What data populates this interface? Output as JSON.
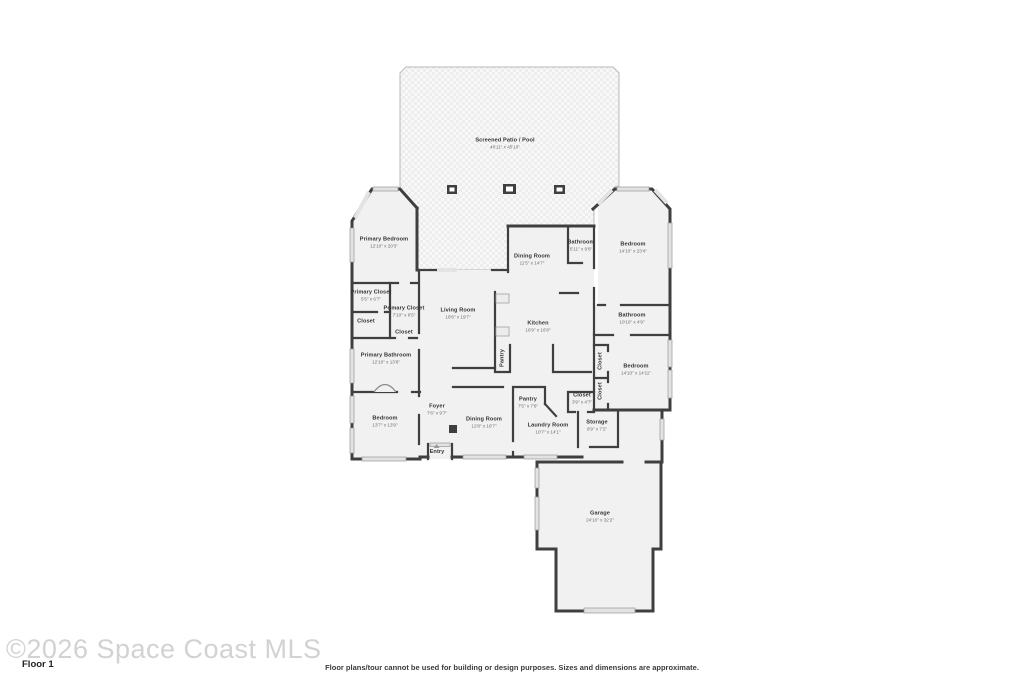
{
  "meta": {
    "floor_label": "Floor 1",
    "watermark": "©2026 Space Coast MLS",
    "disclaimer": "Floor plans/tour cannot be used for building or design purposes. Sizes and dimensions are approximate."
  },
  "colors": {
    "wall": "#3f3f3f",
    "room_fill": "#f1f1f2",
    "window": "#e3e3e3",
    "label": "#333333",
    "dimension_text": "#6e6e6e",
    "watermark": "#d2d2d2"
  },
  "rooms": [
    {
      "id": "screened-patio-pool",
      "name": "Screened Patio / Pool",
      "dims": "46'11\" x 45'10\"",
      "x": 505,
      "y": 144
    },
    {
      "id": "primary-bedroom",
      "name": "Primary Bedroom",
      "dims": "12'10\" x 20'3\"",
      "x": 384,
      "y": 243
    },
    {
      "id": "dining-room-top",
      "name": "Dining Room",
      "dims": "11'5\" x 14'7\"",
      "x": 532,
      "y": 260
    },
    {
      "id": "bathroom-top",
      "name": "Bathroom",
      "dims": "5'11\" x 9'8\"",
      "x": 581,
      "y": 246
    },
    {
      "id": "bedroom-top-right",
      "name": "Bedroom",
      "dims": "14'10\" x 23'4\"",
      "x": 633,
      "y": 248
    },
    {
      "id": "primary-closet-1",
      "name": "Primary Closet",
      "dims": "5'5\" x 6'7\"",
      "x": 371,
      "y": 296
    },
    {
      "id": "closet-left",
      "name": "Closet",
      "x": 366,
      "y": 322
    },
    {
      "id": "primary-closet-2",
      "name": "Primary Closet",
      "dims": "7'10\" x 6'5\"",
      "x": 404,
      "y": 312
    },
    {
      "id": "closet-small",
      "name": "Closet",
      "x": 404,
      "y": 333
    },
    {
      "id": "living-room",
      "name": "Living Room",
      "dims": "18'6\" x 19'7\"",
      "x": 458,
      "y": 314
    },
    {
      "id": "kitchen",
      "name": "Kitchen",
      "dims": "16'9\" x 16'8\"",
      "x": 538,
      "y": 327
    },
    {
      "id": "pantry-kitchen",
      "name": "Pantry",
      "x": 503,
      "y": 358,
      "rot": true
    },
    {
      "id": "bathroom-right",
      "name": "Bathroom",
      "dims": "10'10\" x 4'9\"",
      "x": 632,
      "y": 319
    },
    {
      "id": "bedroom-right",
      "name": "Bedroom",
      "dims": "14'10\" x 14'11\"",
      "x": 636,
      "y": 370
    },
    {
      "id": "closet-vertical-1",
      "name": "Closet",
      "x": 601,
      "y": 361,
      "rot": true
    },
    {
      "id": "closet-vertical-2",
      "name": "Closet",
      "x": 601,
      "y": 391,
      "rot": true
    },
    {
      "id": "primary-bathroom",
      "name": "Primary Bathroom",
      "dims": "12'10\" x 13'6\"",
      "x": 386,
      "y": 359
    },
    {
      "id": "bedroom-bottom-left",
      "name": "Bedroom",
      "dims": "13'7\" x 13'9\"",
      "x": 385,
      "y": 422
    },
    {
      "id": "foyer",
      "name": "Foyer",
      "dims": "7'6\" x 9'7\"",
      "x": 437,
      "y": 410
    },
    {
      "id": "dining-room-bottom",
      "name": "Dining Room",
      "dims": "12'8\" x 16'7\"",
      "x": 484,
      "y": 423
    },
    {
      "id": "pantry-bottom",
      "name": "Pantry",
      "dims": "7'5\" x 7'6\"",
      "x": 528,
      "y": 403
    },
    {
      "id": "laundry-room",
      "name": "Laundry Room",
      "dims": "10'7\" x 14'1\"",
      "x": 548,
      "y": 429
    },
    {
      "id": "closet-hall",
      "name": "Closet",
      "dims": "3'9\" x 4'7\"",
      "x": 582,
      "y": 399
    },
    {
      "id": "storage",
      "name": "Storage",
      "dims": "8'9\" x 7'2\"",
      "x": 597,
      "y": 426
    },
    {
      "id": "entry",
      "name": "Entry",
      "x": 437,
      "y": 450,
      "marker": true
    },
    {
      "id": "garage",
      "name": "Garage",
      "dims": "24'10\" x 32'2\"",
      "x": 600,
      "y": 517
    }
  ]
}
